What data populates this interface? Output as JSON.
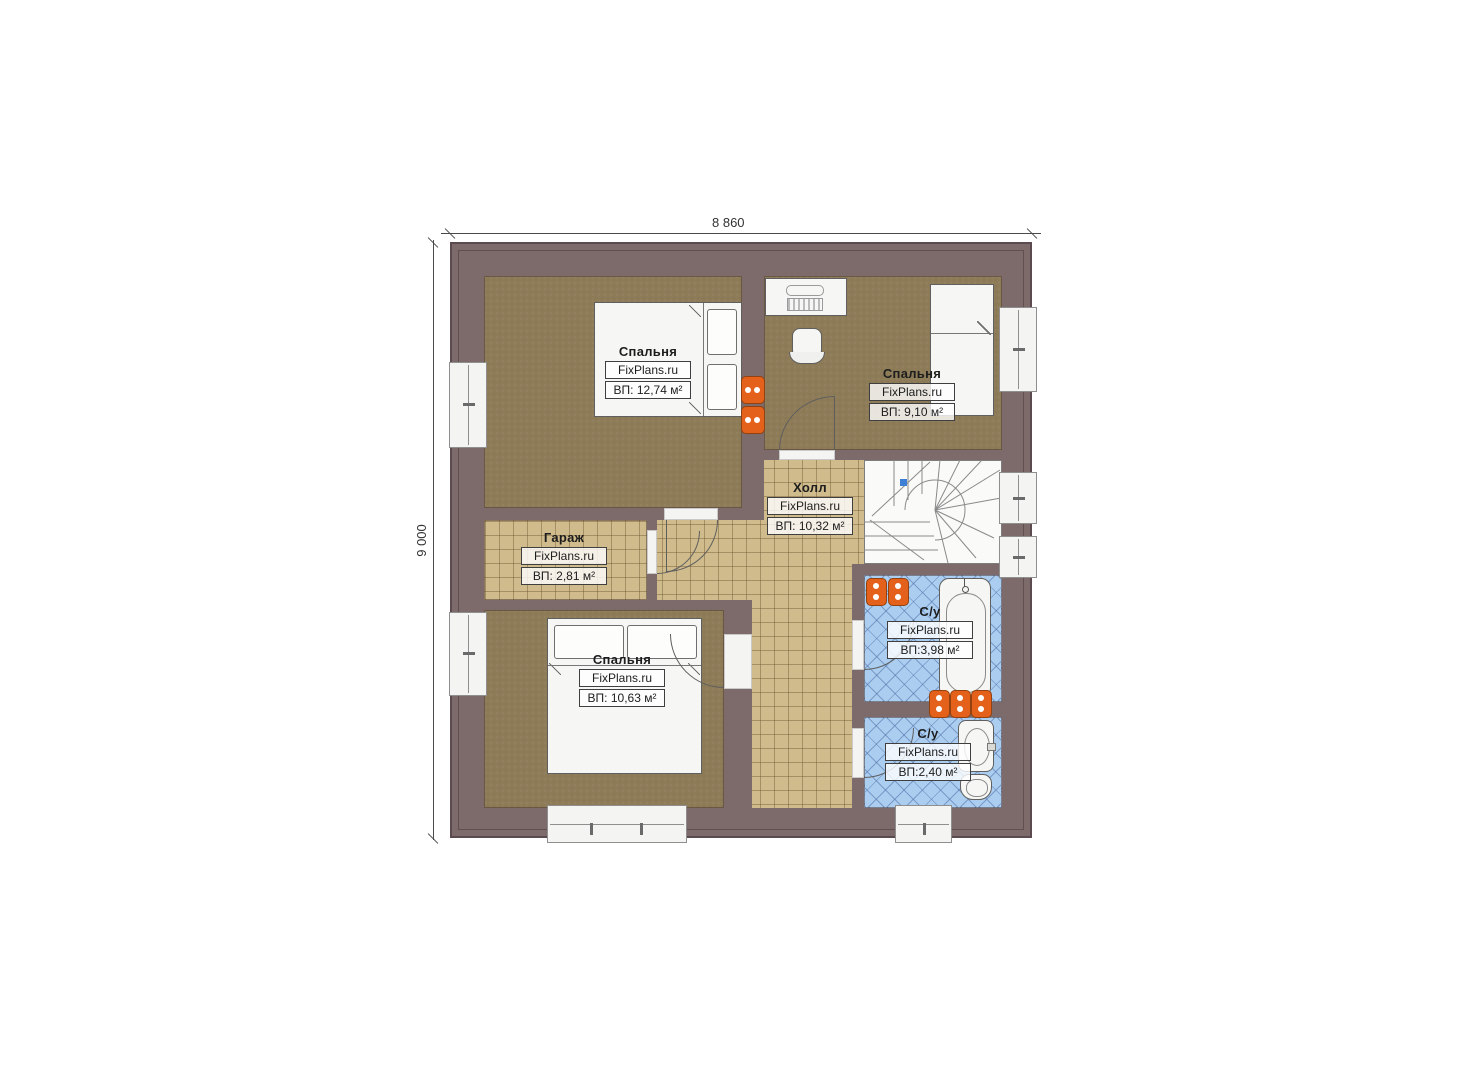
{
  "dimensions": {
    "width_label": "8 860",
    "height_label": "9 000"
  },
  "brand": "FixPlans.ru",
  "rooms": [
    {
      "name": "Спальня",
      "brand": "FixPlans.ru",
      "area": "ВП: 12,74 м²"
    },
    {
      "name": "Спальня",
      "brand": "FixPlans.ru",
      "area": "ВП: 9,10 м²"
    },
    {
      "name": "Холл",
      "brand": "FixPlans.ru",
      "area": "ВП: 10,32 м²"
    },
    {
      "name": "Гараж",
      "brand": "FixPlans.ru",
      "area": "ВП: 2,81 м²"
    },
    {
      "name": "Спальня",
      "brand": "FixPlans.ru",
      "area": "ВП: 10,63 м²"
    },
    {
      "name": "С/у",
      "brand": "FixPlans.ru",
      "area": "ВП:3,98 м²"
    },
    {
      "name": "С/у",
      "brand": "FixPlans.ru",
      "area": "ВП:2,40 м²"
    }
  ],
  "colors": {
    "wall": "#7d6a6b",
    "bedroom_floor": "#8e7c59",
    "tile_floor": "#cfbb8c",
    "bath_floor": "#abcdf0",
    "radiator": "#e4611b",
    "fixture_white": "#f6f6f4",
    "stair_marker": "#3d7fd4"
  }
}
